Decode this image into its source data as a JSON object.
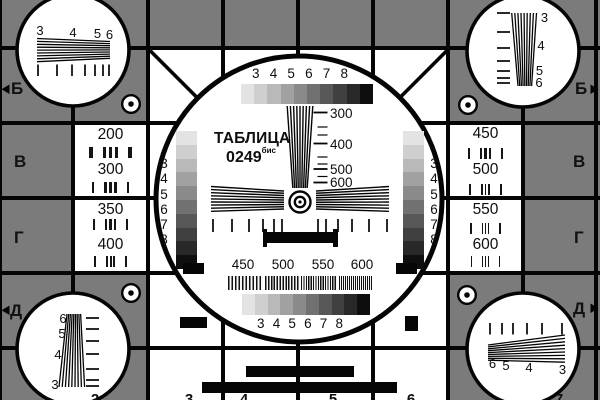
{
  "colors": {
    "background": "#7b7b7b",
    "foreground": "#0e0e0e",
    "white": "#ffffff",
    "grayscale_steps": [
      "#e3e3e3",
      "#cfcfcf",
      "#b9b9b9",
      "#a1a1a1",
      "#8a8a8a",
      "#717171",
      "#585858",
      "#404040",
      "#282828",
      "#0e0e0e"
    ]
  },
  "title": {
    "line1": "ТАБЛИЦА",
    "line2": "0249",
    "superscript": "бис"
  },
  "row_letters": {
    "left": [
      "Б",
      "В",
      "Г",
      "Д"
    ],
    "right": [
      "Б",
      "В",
      "Г",
      "Д"
    ]
  },
  "column_digits": {
    "top": [
      "2",
      "3",
      "4",
      "5",
      "6",
      "7"
    ],
    "bottom": [
      "2",
      "3",
      "4",
      "5",
      "6",
      "7"
    ]
  },
  "center_circle": {
    "top_scale_numbers": [
      "3",
      "4",
      "5",
      "6",
      "7",
      "8"
    ],
    "bottom_scale_numbers": [
      "3",
      "4",
      "5",
      "6",
      "7",
      "8"
    ],
    "left_gray_numbers": [
      "3",
      "4",
      "5",
      "6",
      "7",
      "8"
    ],
    "right_gray_numbers": [
      "3",
      "4",
      "5",
      "6",
      "7",
      "8"
    ],
    "wedge_line_labels": [
      "300",
      "400",
      "500",
      "600"
    ],
    "burst_labels": [
      "450",
      "500",
      "550",
      "600"
    ]
  },
  "side_cells": {
    "left_upper": [
      "200",
      "300"
    ],
    "left_lower": [
      "350",
      "400"
    ],
    "right_upper": [
      "450",
      "500"
    ],
    "right_lower": [
      "550",
      "600"
    ]
  },
  "corner_circles": {
    "top_left": [
      "3",
      "4",
      "5",
      "6"
    ],
    "top_right": [
      "3",
      "4",
      "5",
      "6"
    ],
    "bottom_left": [
      "6",
      "5",
      "4",
      "3"
    ],
    "bottom_right": [
      "6",
      "5",
      "4",
      "3"
    ]
  }
}
